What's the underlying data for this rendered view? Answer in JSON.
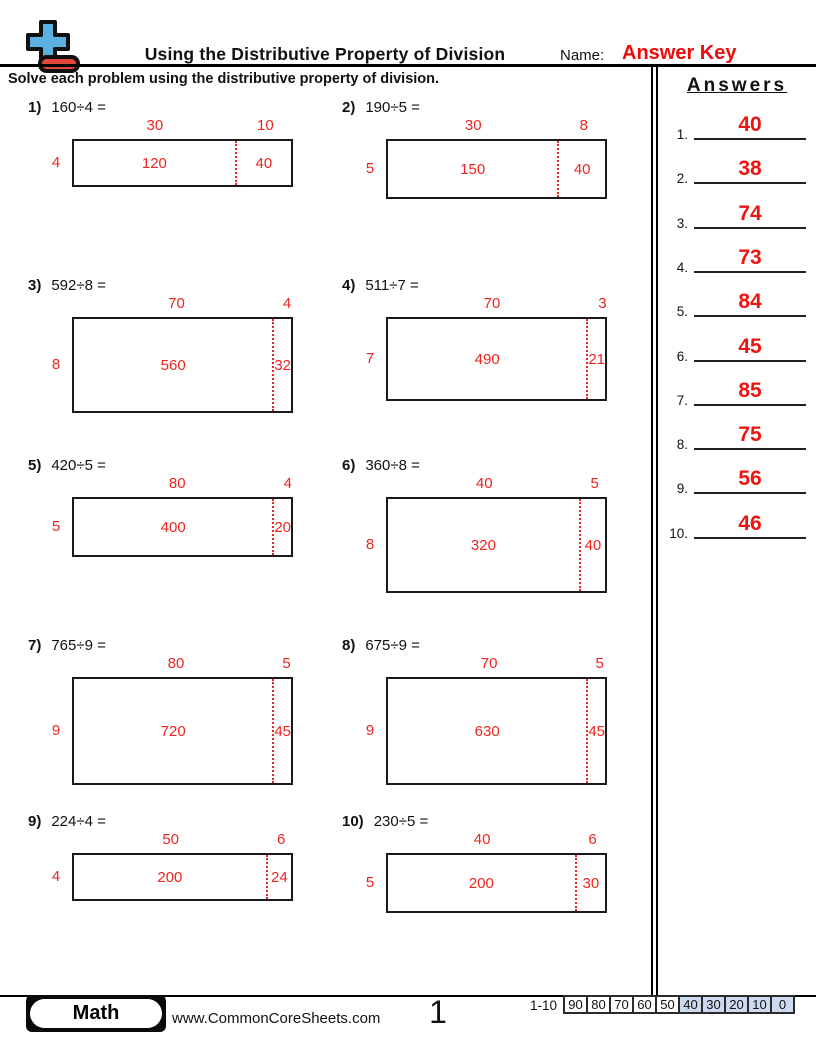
{
  "header": {
    "title": "Using the Distributive Property of Division",
    "name_label": "Name:",
    "name_value": "Answer Key"
  },
  "instructions": "Solve each problem using the distributive property of division.",
  "problems": [
    {
      "num": "1)",
      "expression": "160÷4 =",
      "divisor": 4,
      "tens": 30,
      "ones": 10,
      "tens_product": 120,
      "ones_product": 40
    },
    {
      "num": "2)",
      "expression": "190÷5 =",
      "divisor": 5,
      "tens": 30,
      "ones": 8,
      "tens_product": 150,
      "ones_product": 40
    },
    {
      "num": "3)",
      "expression": "592÷8 =",
      "divisor": 8,
      "tens": 70,
      "ones": 4,
      "tens_product": 560,
      "ones_product": 32
    },
    {
      "num": "4)",
      "expression": "511÷7 =",
      "divisor": 7,
      "tens": 70,
      "ones": 3,
      "tens_product": 490,
      "ones_product": 21
    },
    {
      "num": "5)",
      "expression": "420÷5 =",
      "divisor": 5,
      "tens": 80,
      "ones": 4,
      "tens_product": 400,
      "ones_product": 20
    },
    {
      "num": "6)",
      "expression": "360÷8 =",
      "divisor": 8,
      "tens": 40,
      "ones": 5,
      "tens_product": 320,
      "ones_product": 40
    },
    {
      "num": "7)",
      "expression": "765÷9 =",
      "divisor": 9,
      "tens": 80,
      "ones": 5,
      "tens_product": 720,
      "ones_product": 45
    },
    {
      "num": "8)",
      "expression": "675÷9 =",
      "divisor": 9,
      "tens": 70,
      "ones": 5,
      "tens_product": 630,
      "ones_product": 45
    },
    {
      "num": "9)",
      "expression": "224÷4 =",
      "divisor": 4,
      "tens": 50,
      "ones": 6,
      "tens_product": 200,
      "ones_product": 24
    },
    {
      "num": "10)",
      "expression": "230÷5 =",
      "divisor": 5,
      "tens": 40,
      "ones": 6,
      "tens_product": 200,
      "ones_product": 30
    }
  ],
  "answers_panel": {
    "title": "Answers",
    "items": [
      {
        "num": "1.",
        "value": 40
      },
      {
        "num": "2.",
        "value": 38
      },
      {
        "num": "3.",
        "value": 74
      },
      {
        "num": "4.",
        "value": 73
      },
      {
        "num": "5.",
        "value": 84
      },
      {
        "num": "6.",
        "value": 45
      },
      {
        "num": "7.",
        "value": 85
      },
      {
        "num": "8.",
        "value": 75
      },
      {
        "num": "9.",
        "value": 56
      },
      {
        "num": "10.",
        "value": 46
      }
    ]
  },
  "footer": {
    "subject": "Math",
    "website": "www.CommonCoreSheets.com",
    "page_number": "1",
    "score_table": {
      "range_label": "1-10",
      "cells": [
        {
          "label": "90",
          "highlight": false
        },
        {
          "label": "80",
          "highlight": false
        },
        {
          "label": "70",
          "highlight": false
        },
        {
          "label": "60",
          "highlight": false
        },
        {
          "label": "50",
          "highlight": false
        },
        {
          "label": "40",
          "highlight": true
        },
        {
          "label": "30",
          "highlight": true
        },
        {
          "label": "20",
          "highlight": true
        },
        {
          "label": "10",
          "highlight": true
        },
        {
          "label": "0",
          "highlight": true
        }
      ]
    }
  },
  "colors": {
    "accent_red": "#ee2420",
    "answer_key_red": "#f00a0a",
    "logo_blue": "#5bb2e0",
    "logo_red": "#e2473d",
    "score_highlight_blue": "#ccd9f1"
  }
}
